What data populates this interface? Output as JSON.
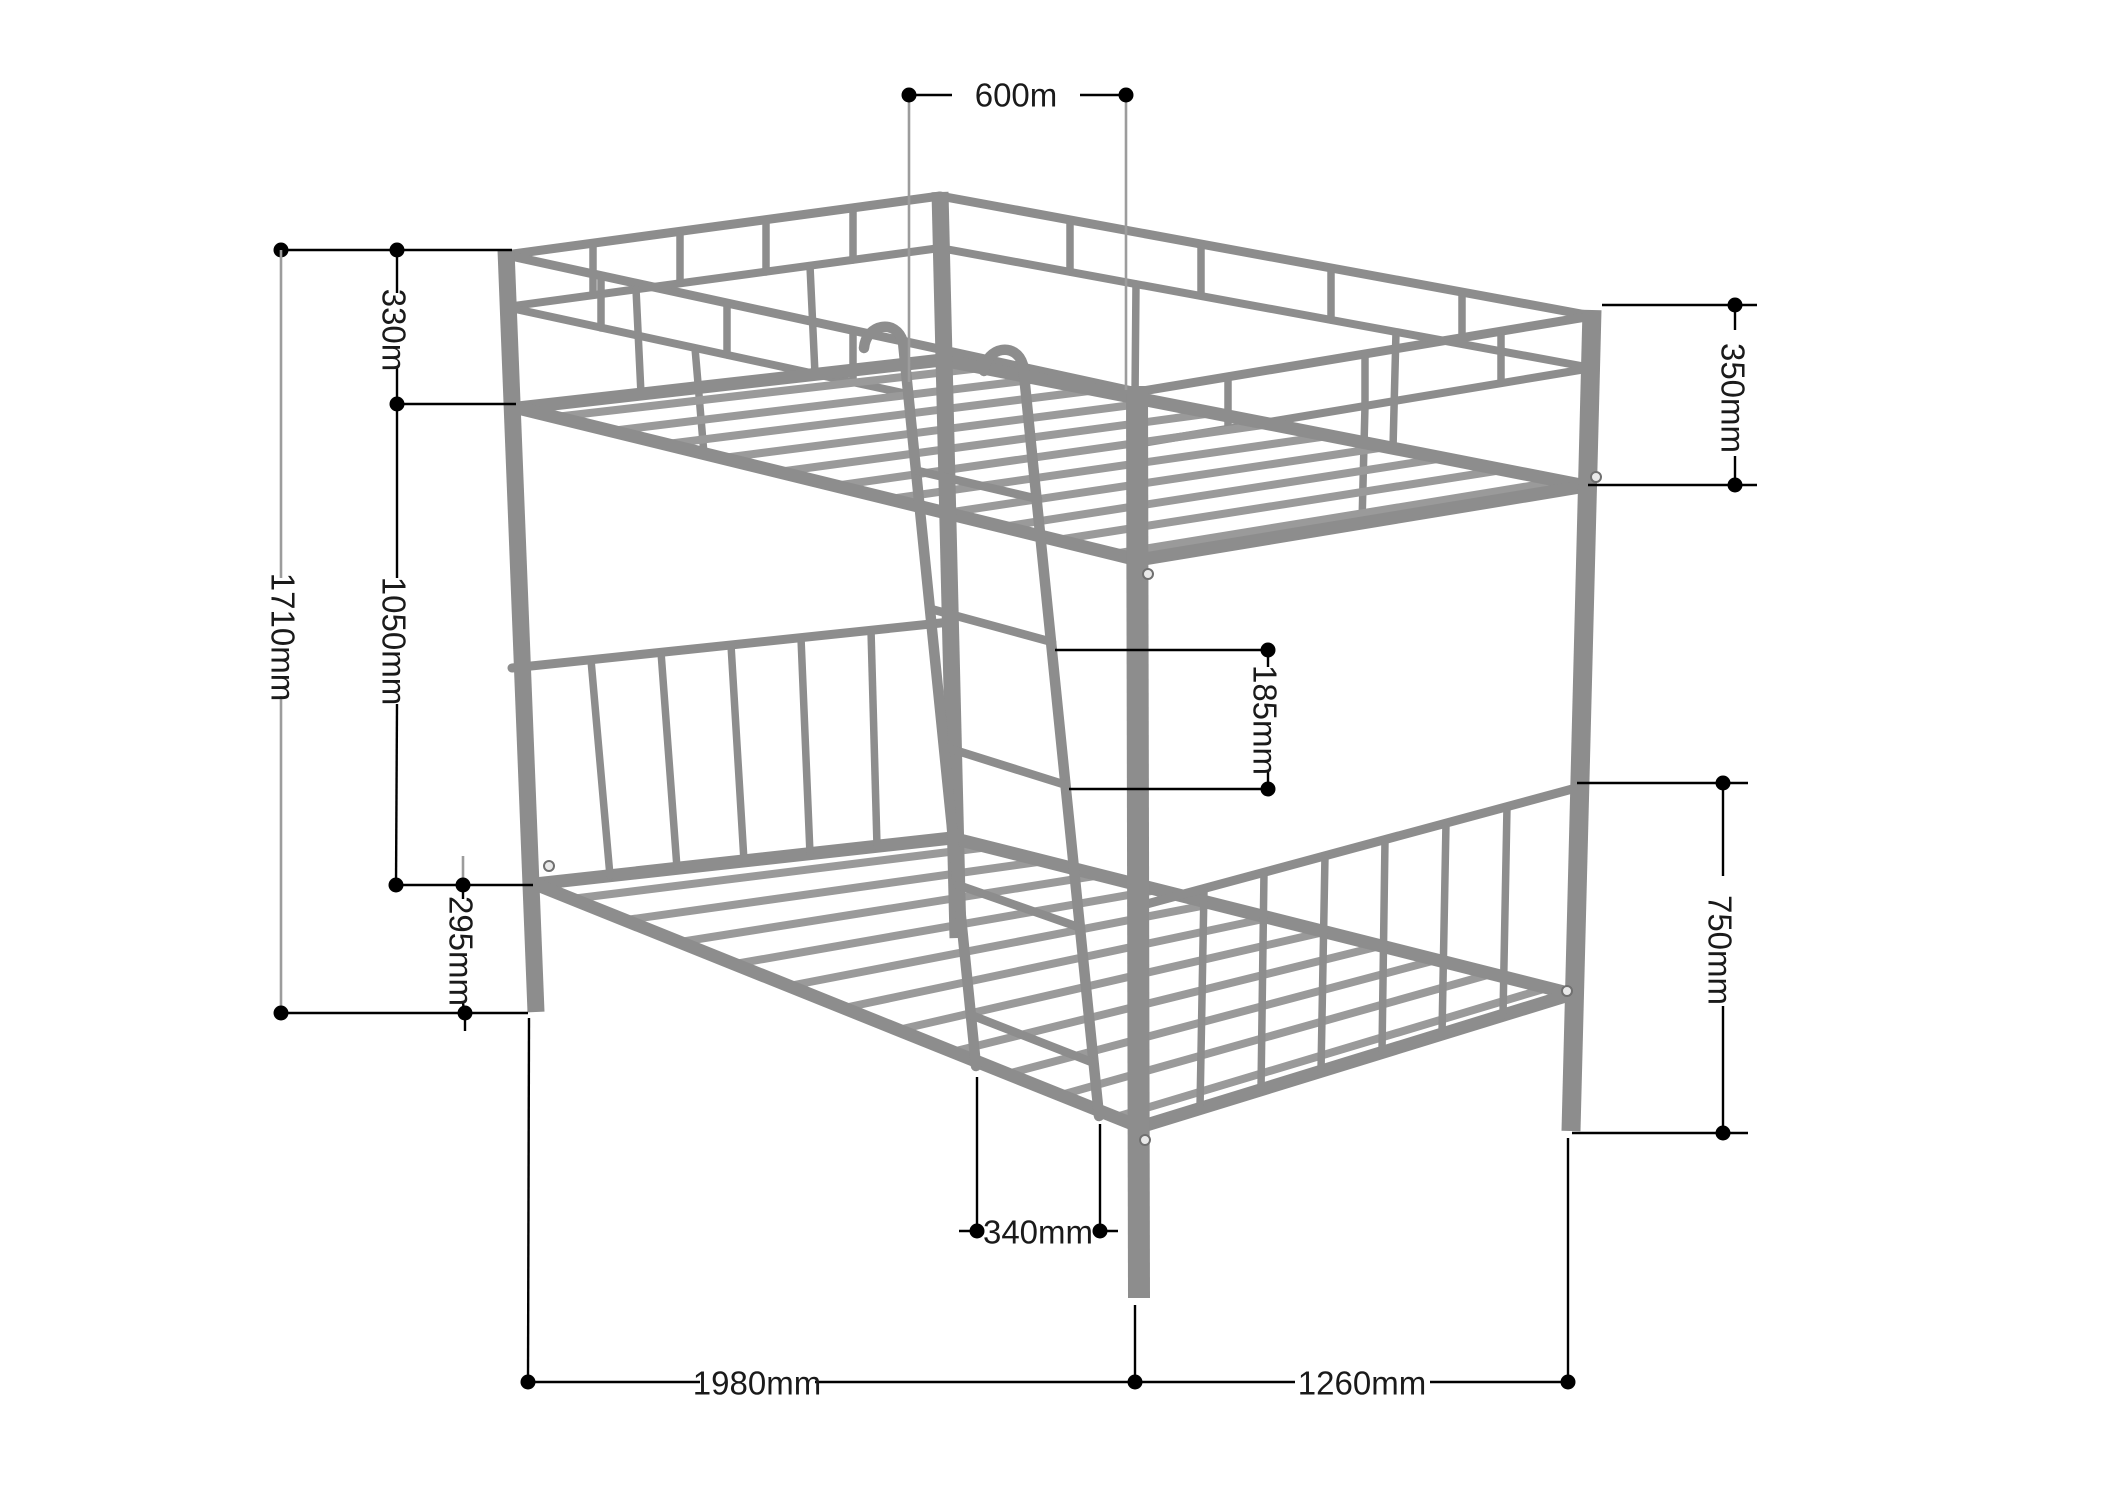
{
  "diagram": {
    "type": "furniture-dimension-diagram",
    "subject": "metal bunk bed frame wireframe, isometric view",
    "colors": {
      "background": "#ffffff",
      "frame": "#8d8d8d",
      "frame_light": "#9a9a9a",
      "dimension": "#000000",
      "extension": "#9c9c9c",
      "text": "#1a1a1a"
    },
    "dims": [
      {
        "id": "ladder-opening-width-top",
        "label": "600m",
        "orientation": "horizontal"
      },
      {
        "id": "guardrail-height-left",
        "label": "330m",
        "orientation": "vertical"
      },
      {
        "id": "overall-height",
        "label": "1710mm",
        "orientation": "vertical"
      },
      {
        "id": "bunk-to-bunk-spacing",
        "label": "1050mm",
        "orientation": "vertical"
      },
      {
        "id": "lower-platform-height",
        "label": "295mm",
        "orientation": "vertical"
      },
      {
        "id": "guardrail-height-right",
        "label": "350mm",
        "orientation": "vertical"
      },
      {
        "id": "ladder-rung-spacing",
        "label": "185mm",
        "orientation": "vertical"
      },
      {
        "id": "footboard-height",
        "label": "750mm",
        "orientation": "vertical"
      },
      {
        "id": "ladder-width-bottom",
        "label": "340mm",
        "orientation": "horizontal"
      },
      {
        "id": "bed-length",
        "label": "1980mm",
        "orientation": "horizontal"
      },
      {
        "id": "bed-width",
        "label": "1260mm",
        "orientation": "horizontal"
      }
    ]
  }
}
